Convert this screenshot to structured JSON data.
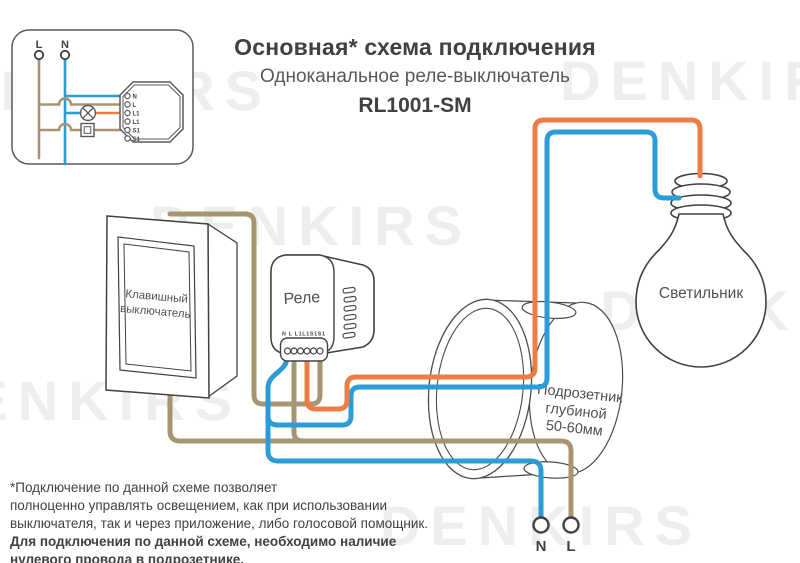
{
  "title": "Основная* схема подключения",
  "subtitle": "Одноканальное реле-выключатель",
  "model": "RL1001-SM",
  "watermark": "DENKIRS",
  "colors": {
    "wire_blue": "#2b9cd8",
    "wire_orange": "#ee7c45",
    "wire_brown": "#a79571",
    "outline": "#4b4c4e",
    "text_dark": "#414042",
    "text_gray": "#58595b"
  },
  "inset": {
    "l_label": "L",
    "n_label": "N",
    "terminals": [
      "N",
      "L",
      "L1",
      "L1",
      "S1",
      "S1"
    ]
  },
  "relay": {
    "label": "Реле",
    "terminals_label": "N L L1L1S1S1"
  },
  "switch": {
    "label_line1": "Клавишный",
    "label_line2": "выключатель"
  },
  "bulb": {
    "label": "Светильник"
  },
  "box": {
    "line1": "Подрозетник",
    "line2": "глубиной",
    "line3": "50-60мм"
  },
  "mains": {
    "n_label": "N",
    "l_label": "L"
  },
  "footnote": {
    "line1": "*Подключение по данной схеме позволяет",
    "line2": "полноценно управлять освещением, как при использовании",
    "line3": "выключателя, так и через приложение, либо голосовой помощник.",
    "bold1": "Для подключения по данной схеме, необходимо наличие",
    "bold2": "нулевого провода в подрозетнике."
  }
}
